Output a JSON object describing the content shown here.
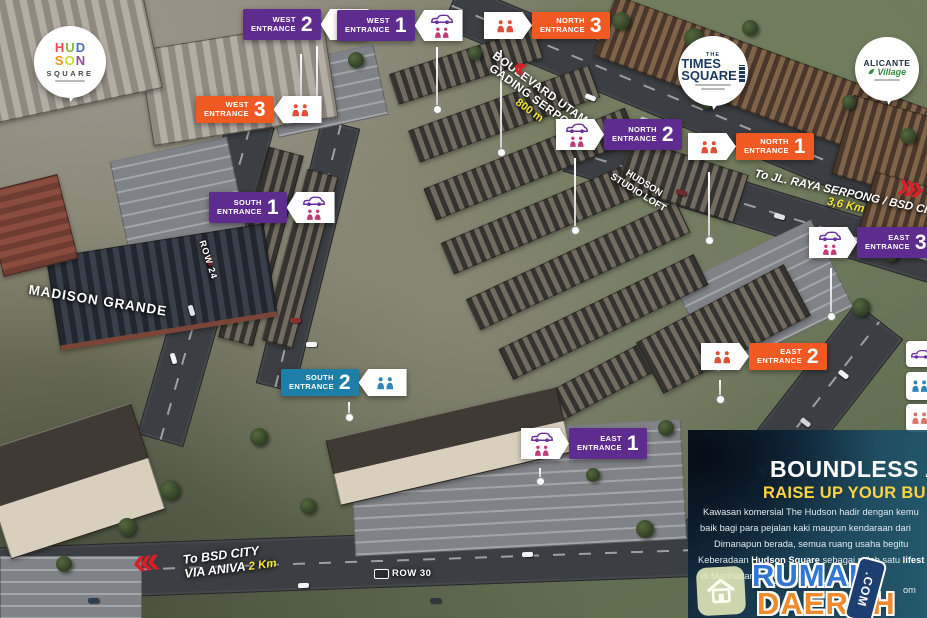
{
  "colors": {
    "purple": "#5e2b8f",
    "orange": "#f05a22",
    "blue": "#1d7fa8",
    "yellow": "#f3e33c",
    "panel_yellow": "#ffd23f",
    "red": "#d6202a",
    "wm_blue": "#3076d2",
    "wm_orange": "#ef8b2d"
  },
  "logos": {
    "hudson": {
      "letters": [
        "H",
        "U",
        "D",
        "S",
        "O",
        "N"
      ],
      "square": "SQUARE"
    },
    "times": {
      "the": "THE",
      "times": "TIMES",
      "square": "SQUARE"
    },
    "alicante": {
      "name": "ALICANTE",
      "sub": "Village"
    }
  },
  "entrances": [
    {
      "dir": "WEST",
      "word": "ENTRANCE",
      "num": "2"
    },
    {
      "dir": "WEST",
      "word": "ENTRANCE",
      "num": "1"
    },
    {
      "dir": "NORTH",
      "word": "ENTRANCE",
      "num": "3"
    },
    {
      "dir": "WEST",
      "word": "ENTRANCE",
      "num": "3"
    },
    {
      "dir": "NORTH",
      "word": "ENTRANCE",
      "num": "2"
    },
    {
      "dir": "NORTH",
      "word": "ENTRANCE",
      "num": "1"
    },
    {
      "dir": "EAST",
      "word": "ENTRANCE",
      "num": "3"
    },
    {
      "dir": "EAST",
      "word": "ENTRANCE",
      "num": "2"
    },
    {
      "dir": "EAST",
      "word": "ENTRANCE",
      "num": "1"
    },
    {
      "dir": "SOUTH",
      "word": "ENTRANCE",
      "num": "1"
    },
    {
      "dir": "SOUTH",
      "word": "ENTRANCE",
      "num": "2"
    }
  ],
  "labels": {
    "boulevard_1": "BOULEVARD UTAMA",
    "boulevard_2": "GADING SERPONG",
    "boulevard_dist": "800 m",
    "serpong": "To JL. RAYA SERPONG / BSD CITY",
    "serpong_dist": "3,6 Km",
    "bsd_1": "To BSD CITY",
    "bsd_2": "VIA ANIVA",
    "bsd_dist": "2 Km",
    "madison": "MADISON GRANDE",
    "loft_1": "HUDSON",
    "loft_2": "STUDIO LOFT",
    "row24": "ROW 24",
    "row30": "ROW 30"
  },
  "panel": {
    "title": "BOUNDLESS A",
    "subtitle": "RAISE UP YOUR BU",
    "p1": "Kawasan komersial The Hudson hadir dengan kemu",
    "p2": "baik bagi para pejalan kaki maupun kendaraan dari",
    "p3": "Dimanapun berada, semua ruang usaha begitu",
    "p4a": "Keberadaan ",
    "p4b": "Hudson Square",
    "p4c": " sebagai salah satu ",
    "p4d": "lifest",
    "p5": "di Manhattan Distri",
    "frag1": "icon",
    "frag2": "om"
  },
  "watermark": {
    "l1": "RUMAH",
    "l2": "DAERAH",
    "suffix": ".COM"
  }
}
